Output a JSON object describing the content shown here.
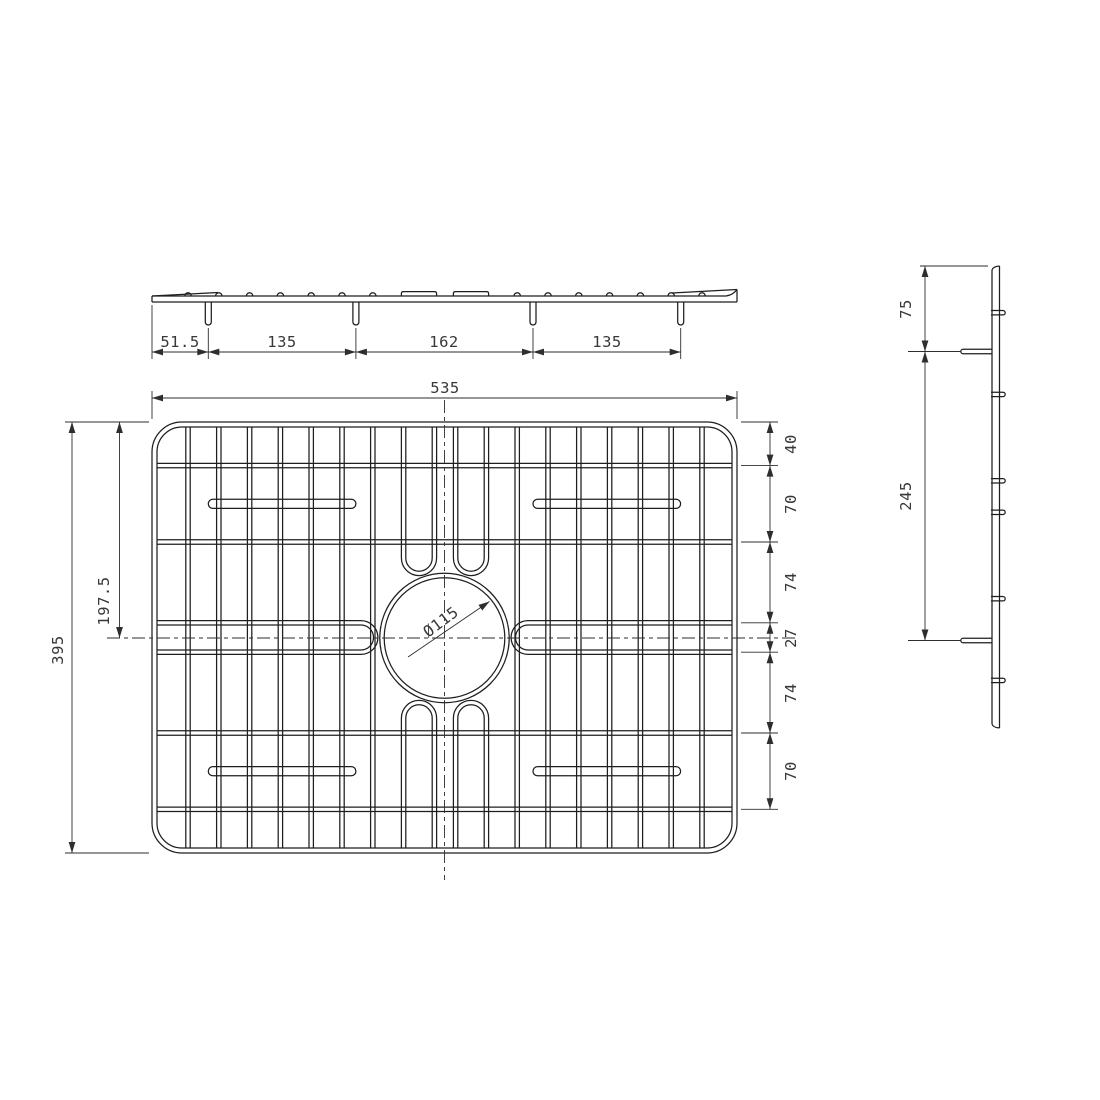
{
  "front_view": {
    "dims": [
      "51.5",
      "135",
      "162",
      "135"
    ]
  },
  "plan_view": {
    "overall_width": "535",
    "overall_height": "395",
    "vertical_center_offset": "197.5",
    "hole_diameter": "Ø115",
    "right_dims": [
      "40",
      "70",
      "74",
      "27",
      "74",
      "70"
    ]
  },
  "side_view": {
    "top_to_foot": "75",
    "foot_spacing": "245"
  }
}
